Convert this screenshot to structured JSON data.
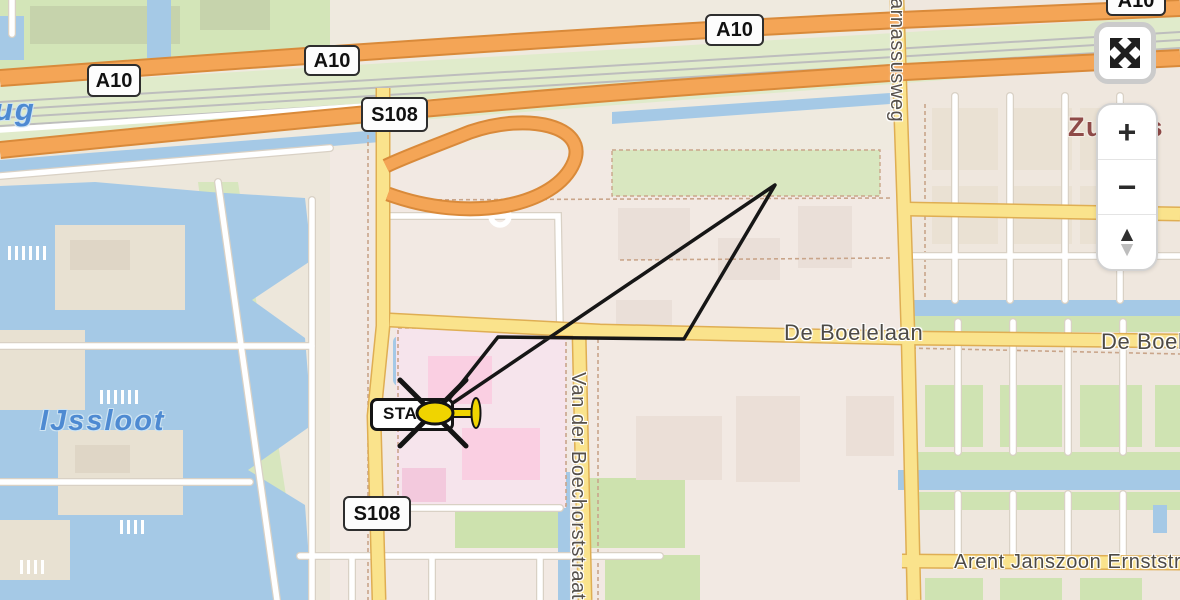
{
  "map": {
    "badges": [
      {
        "id": "a10-left",
        "text": "A10",
        "x": 87,
        "y": 64,
        "w": 50,
        "h": 29
      },
      {
        "id": "a10-mid",
        "text": "A10",
        "x": 304,
        "y": 45,
        "w": 52,
        "h": 27
      },
      {
        "id": "a10-top",
        "text": "A10",
        "x": 705,
        "y": 14,
        "w": 55,
        "h": 28
      },
      {
        "id": "a10-corner",
        "text": "A10",
        "x": 1106,
        "y": -15,
        "w": 56,
        "h": 27
      },
      {
        "id": "s108-top",
        "text": "S108",
        "x": 361,
        "y": 97,
        "w": 63,
        "h": 31
      },
      {
        "id": "s108-bottom",
        "text": "S108",
        "x": 343,
        "y": 496,
        "w": 64,
        "h": 31
      }
    ],
    "street_labels": [
      {
        "id": "de-boelelaan",
        "text": "De Boelelaan",
        "x": 784,
        "y": 320,
        "size": 22,
        "vertical": false
      },
      {
        "id": "de-boelelaan-east",
        "text": "De Boelelaan",
        "x": 1101,
        "y": 329,
        "size": 22,
        "vertical": false
      },
      {
        "id": "arent-janszoon-ernststraat",
        "text": "Arent Janszoon Ernststraat",
        "x": 954,
        "y": 551,
        "size": 20,
        "vertical": false
      },
      {
        "id": "parnassusweg",
        "text": "Parnassusweg",
        "x": 908,
        "y": -16,
        "size": 20,
        "vertical": true
      },
      {
        "id": "van-der-boechorststraat",
        "text": "Van der Boechorststraat",
        "x": 589,
        "y": 372,
        "size": 20,
        "vertical": true
      }
    ],
    "water_labels": [
      {
        "id": "ijssloot",
        "text": "IJssloot",
        "x": 40,
        "y": 405,
        "size": 29
      },
      {
        "id": "water-name-partial",
        "text": "ug",
        "x": -6,
        "y": 92,
        "size": 31
      }
    ],
    "district_labels": [
      {
        "id": "zuidas",
        "text": "Zuidas",
        "x": 1068,
        "y": 112,
        "size": 27
      }
    ],
    "track_marker": {
      "label": "START"
    }
  },
  "controls": {
    "fullscreen_icon": "expand-arrows",
    "zoom_in": "+",
    "zoom_out": "−",
    "pan_up": "▲",
    "pan_down": "▼"
  },
  "colors": {
    "water": "#A5C9E6",
    "water_label": "#4E8AD2",
    "motorway": "#F4A556",
    "secondary_road": "#FAE38C",
    "green_area": "#CFE3B2",
    "district_label": "#8E4A48",
    "street_label": "#4D4A45",
    "flight_track": "#161616",
    "helicopter": "#F0D400"
  }
}
